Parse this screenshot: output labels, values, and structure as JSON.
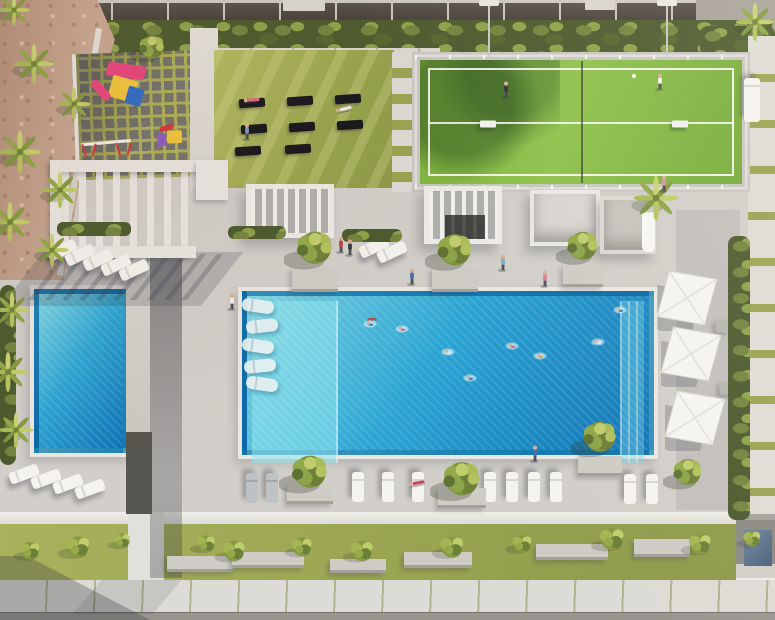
{
  "meta": {
    "description": "Aerial 3D architectural rendering of a residential amenity deck: main pool with swimmers and in-water loungers, secondary pool, padel court with two players, yoga lawn with mats, children's playground, pergolas, cabanas, sun loungers, white patio umbrellas, palm trees and landscaped walkways. No visible text or UI controls."
  },
  "palette": {
    "deck": "#d2cfca",
    "sand": "#c2a08d",
    "hedge_dark": "#4c5a2e",
    "water_light": "#7ed7e4",
    "water_mid": "#2aa4d3",
    "water_deep": "#0d72b4",
    "tile_border": "#0a5d97",
    "coping": "#eae8e3",
    "court_green": "#7cb23e",
    "lawn": "#9fab54",
    "paver": "#dddbd5",
    "paver_joint": "#b2b191",
    "mat_black": "#17171b",
    "umbrella_white": "#f5f4f0",
    "play_pink": "#e8457e",
    "play_yellow": "#f2c53d",
    "play_blue": "#2f6bc4",
    "play_purple": "#8e5bbf",
    "play_red": "#d8333f",
    "skin": "#d8ae92"
  },
  "scene": {
    "width": 775,
    "height": 620,
    "counts": {
      "pools": 2,
      "padel_courts": 1,
      "umbrellas": 3,
      "yoga_mats": 8,
      "pool_loungers": 5,
      "sun_loungers": 22,
      "swimmers": 8
    },
    "objects": [
      {
        "t": "palm",
        "x": 14,
        "y": 10,
        "s": 40
      },
      {
        "t": "palm",
        "x": 34,
        "y": 64,
        "s": 50
      },
      {
        "t": "palm",
        "x": 74,
        "y": 104,
        "s": 42
      },
      {
        "t": "palm",
        "x": 20,
        "y": 152,
        "s": 54
      },
      {
        "t": "palm",
        "x": 60,
        "y": 190,
        "s": 46
      },
      {
        "t": "palm",
        "x": 10,
        "y": 222,
        "s": 50
      },
      {
        "t": "palm",
        "x": 52,
        "y": 250,
        "s": 42
      },
      {
        "t": "palm",
        "x": 12,
        "y": 310,
        "s": 44
      },
      {
        "t": "palm",
        "x": 8,
        "y": 372,
        "s": 50
      },
      {
        "t": "palm",
        "x": 16,
        "y": 430,
        "s": 44
      },
      {
        "t": "palm",
        "x": 656,
        "y": 198,
        "s": 56
      },
      {
        "t": "palm",
        "x": 755,
        "y": 22,
        "s": 48
      },
      {
        "t": "canopy",
        "x": 152,
        "y": 48,
        "s": 44
      },
      {
        "t": "canopy",
        "x": 315,
        "y": 249,
        "s": 62
      },
      {
        "t": "canopy",
        "x": 455,
        "y": 251,
        "s": 60
      },
      {
        "t": "canopy",
        "x": 583,
        "y": 247,
        "s": 54
      },
      {
        "t": "canopy",
        "x": 310,
        "y": 473,
        "s": 62
      },
      {
        "t": "canopy",
        "x": 462,
        "y": 480,
        "s": 64
      },
      {
        "t": "canopy",
        "x": 600,
        "y": 438,
        "s": 58
      },
      {
        "t": "canopy",
        "x": 688,
        "y": 473,
        "s": 50
      },
      {
        "t": "planter",
        "x": 315,
        "y": 280,
        "w": 46,
        "h": 24
      },
      {
        "t": "planter",
        "x": 455,
        "y": 280,
        "w": 46,
        "h": 24
      },
      {
        "t": "planter",
        "x": 583,
        "y": 276,
        "w": 40,
        "h": 22
      },
      {
        "t": "planter",
        "x": 310,
        "y": 494,
        "w": 46,
        "h": 20
      },
      {
        "t": "planter",
        "x": 462,
        "y": 498,
        "w": 48,
        "h": 20
      },
      {
        "t": "planter",
        "x": 600,
        "y": 466,
        "w": 44,
        "h": 20
      },
      {
        "t": "planter",
        "x": 200,
        "y": 564,
        "w": 66,
        "h": 16
      },
      {
        "t": "planter",
        "x": 268,
        "y": 560,
        "w": 72,
        "h": 16
      },
      {
        "t": "planter",
        "x": 358,
        "y": 566,
        "w": 56,
        "h": 14
      },
      {
        "t": "planter",
        "x": 438,
        "y": 560,
        "w": 68,
        "h": 16
      },
      {
        "t": "planter",
        "x": 572,
        "y": 552,
        "w": 72,
        "h": 16
      },
      {
        "t": "planter",
        "x": 662,
        "y": 548,
        "w": 56,
        "h": 18
      },
      {
        "t": "shrub",
        "x": 30,
        "y": 550,
        "s": 40
      },
      {
        "t": "shrub",
        "x": 78,
        "y": 546,
        "s": 48
      },
      {
        "t": "shrub",
        "x": 122,
        "y": 540,
        "s": 34
      },
      {
        "t": "shrub",
        "x": 206,
        "y": 543,
        "s": 38
      },
      {
        "t": "shrub",
        "x": 234,
        "y": 550,
        "s": 46
      },
      {
        "t": "shrub",
        "x": 302,
        "y": 546,
        "s": 42
      },
      {
        "t": "shrub",
        "x": 362,
        "y": 550,
        "s": 46
      },
      {
        "t": "shrub",
        "x": 452,
        "y": 546,
        "s": 48
      },
      {
        "t": "shrub",
        "x": 522,
        "y": 543,
        "s": 40
      },
      {
        "t": "shrub",
        "x": 612,
        "y": 538,
        "s": 50
      },
      {
        "t": "shrub",
        "x": 700,
        "y": 543,
        "s": 46
      },
      {
        "t": "shrub",
        "x": 752,
        "y": 538,
        "s": 36
      },
      {
        "t": "lounger",
        "x": 62,
        "y": 250,
        "r": -25
      },
      {
        "t": "lounger",
        "x": 80,
        "y": 255,
        "r": -25
      },
      {
        "t": "lounger",
        "x": 98,
        "y": 260,
        "r": -25
      },
      {
        "t": "lounger",
        "x": 116,
        "y": 265,
        "r": -25
      },
      {
        "t": "lounger",
        "x": 134,
        "y": 270,
        "r": -25
      },
      {
        "t": "lounger",
        "x": 374,
        "y": 247,
        "r": -25
      },
      {
        "t": "lounger",
        "x": 392,
        "y": 252,
        "r": -25
      },
      {
        "t": "lounger",
        "x": 24,
        "y": 474,
        "r": -20
      },
      {
        "t": "lounger",
        "x": 46,
        "y": 479,
        "r": -20
      },
      {
        "t": "lounger",
        "x": 68,
        "y": 484,
        "r": -20
      },
      {
        "t": "lounger",
        "x": 90,
        "y": 489,
        "r": -20
      },
      {
        "t": "lounger",
        "x": 358,
        "y": 487,
        "r": 90
      },
      {
        "t": "lounger",
        "x": 388,
        "y": 487,
        "r": 90
      },
      {
        "t": "lounger",
        "x": 418,
        "y": 487,
        "r": 90
      },
      {
        "t": "lounger",
        "x": 490,
        "y": 487,
        "r": 90
      },
      {
        "t": "lounger",
        "x": 512,
        "y": 487,
        "r": 90
      },
      {
        "t": "lounger",
        "x": 534,
        "y": 487,
        "r": 90
      },
      {
        "t": "lounger",
        "x": 556,
        "y": 487,
        "r": 90
      },
      {
        "t": "lounger",
        "x": 630,
        "y": 489,
        "r": 90
      },
      {
        "t": "lounger",
        "x": 652,
        "y": 489,
        "r": 90
      },
      {
        "t": "lounger",
        "x": 752,
        "y": 100,
        "r": 90,
        "w": 44,
        "h": 16
      },
      {
        "t": "lounger-gray",
        "x": 252,
        "y": 488,
        "r": 90
      },
      {
        "t": "lounger-gray",
        "x": 272,
        "y": 488,
        "r": 90
      },
      {
        "t": "pool-lounger",
        "x": 258,
        "y": 306,
        "r": 8
      },
      {
        "t": "pool-lounger",
        "x": 262,
        "y": 326,
        "r": -6
      },
      {
        "t": "pool-lounger",
        "x": 258,
        "y": 346,
        "r": 8
      },
      {
        "t": "pool-lounger",
        "x": 260,
        "y": 366,
        "r": -6
      },
      {
        "t": "pool-lounger",
        "x": 262,
        "y": 384,
        "r": 8
      },
      {
        "t": "umbrella",
        "x": 688,
        "y": 300,
        "s": 62
      },
      {
        "t": "umbrella",
        "x": 692,
        "y": 356,
        "s": 62
      },
      {
        "t": "umbrella",
        "x": 696,
        "y": 420,
        "s": 62
      },
      {
        "t": "table",
        "x": 722,
        "y": 326
      },
      {
        "t": "table",
        "x": 726,
        "y": 388
      },
      {
        "t": "mat",
        "x": 252,
        "y": 103,
        "r": -4
      },
      {
        "t": "mat",
        "x": 300,
        "y": 101,
        "r": -4
      },
      {
        "t": "mat",
        "x": 348,
        "y": 99,
        "r": -4
      },
      {
        "t": "mat",
        "x": 254,
        "y": 129,
        "r": -4
      },
      {
        "t": "mat",
        "x": 302,
        "y": 127,
        "r": -4
      },
      {
        "t": "mat",
        "x": 350,
        "y": 125,
        "r": -4
      },
      {
        "t": "mat",
        "x": 248,
        "y": 151,
        "r": -4
      },
      {
        "t": "mat",
        "x": 298,
        "y": 149,
        "r": -4
      },
      {
        "t": "person",
        "x": 341,
        "y": 245,
        "c": "#c23b3b"
      },
      {
        "t": "person",
        "x": 350,
        "y": 248,
        "c": "#32363e"
      },
      {
        "t": "person",
        "x": 503,
        "y": 263,
        "c": "#7fa8c8"
      },
      {
        "t": "person",
        "x": 545,
        "y": 279,
        "c": "#d77fa0"
      },
      {
        "t": "person",
        "x": 664,
        "y": 184,
        "c": "#e08aa8"
      },
      {
        "t": "person",
        "x": 232,
        "y": 302,
        "c": "#f0eeea"
      },
      {
        "t": "person",
        "x": 535,
        "y": 454,
        "c": "#4a6fb0"
      },
      {
        "t": "person",
        "x": 412,
        "y": 277,
        "c": "#4a6fb0"
      },
      {
        "t": "person",
        "x": 506,
        "y": 90,
        "c": "#2e3338"
      },
      {
        "t": "person",
        "x": 660,
        "y": 82,
        "c": "#f2f1ee"
      },
      {
        "t": "person",
        "x": 247,
        "y": 132,
        "c": "#7f98c0"
      },
      {
        "t": "person-lie",
        "x": 417,
        "y": 483,
        "c": "#c84a62",
        "r": -10
      },
      {
        "t": "person-lie",
        "x": 252,
        "y": 100,
        "c": "#e06a8a",
        "r": -4
      },
      {
        "t": "person-lie",
        "x": 344,
        "y": 109,
        "c": "#ececea",
        "r": -14
      },
      {
        "t": "swimmer",
        "x": 370,
        "y": 324,
        "c": "#3a6fb0"
      },
      {
        "t": "swimmer",
        "x": 402,
        "y": 329,
        "c": "#d05a7a"
      },
      {
        "t": "swimmer",
        "x": 448,
        "y": 352,
        "c": "#e8eaec"
      },
      {
        "t": "swimmer",
        "x": 470,
        "y": 378,
        "c": "#3a6fb0"
      },
      {
        "t": "swimmer",
        "x": 512,
        "y": 346,
        "c": "#d05a7a"
      },
      {
        "t": "swimmer",
        "x": 540,
        "y": 356,
        "c": "#caa24a"
      },
      {
        "t": "swimmer",
        "x": 620,
        "y": 310,
        "c": "#3a6fb0"
      },
      {
        "t": "swimmer",
        "x": 598,
        "y": 342,
        "c": "#e8eaec"
      },
      {
        "t": "bird",
        "x": 372,
        "y": 320
      },
      {
        "t": "ball",
        "x": 634,
        "y": 76
      },
      {
        "t": "bench",
        "x": 488,
        "y": 124
      },
      {
        "t": "bench",
        "x": 680,
        "y": 124
      }
    ]
  }
}
